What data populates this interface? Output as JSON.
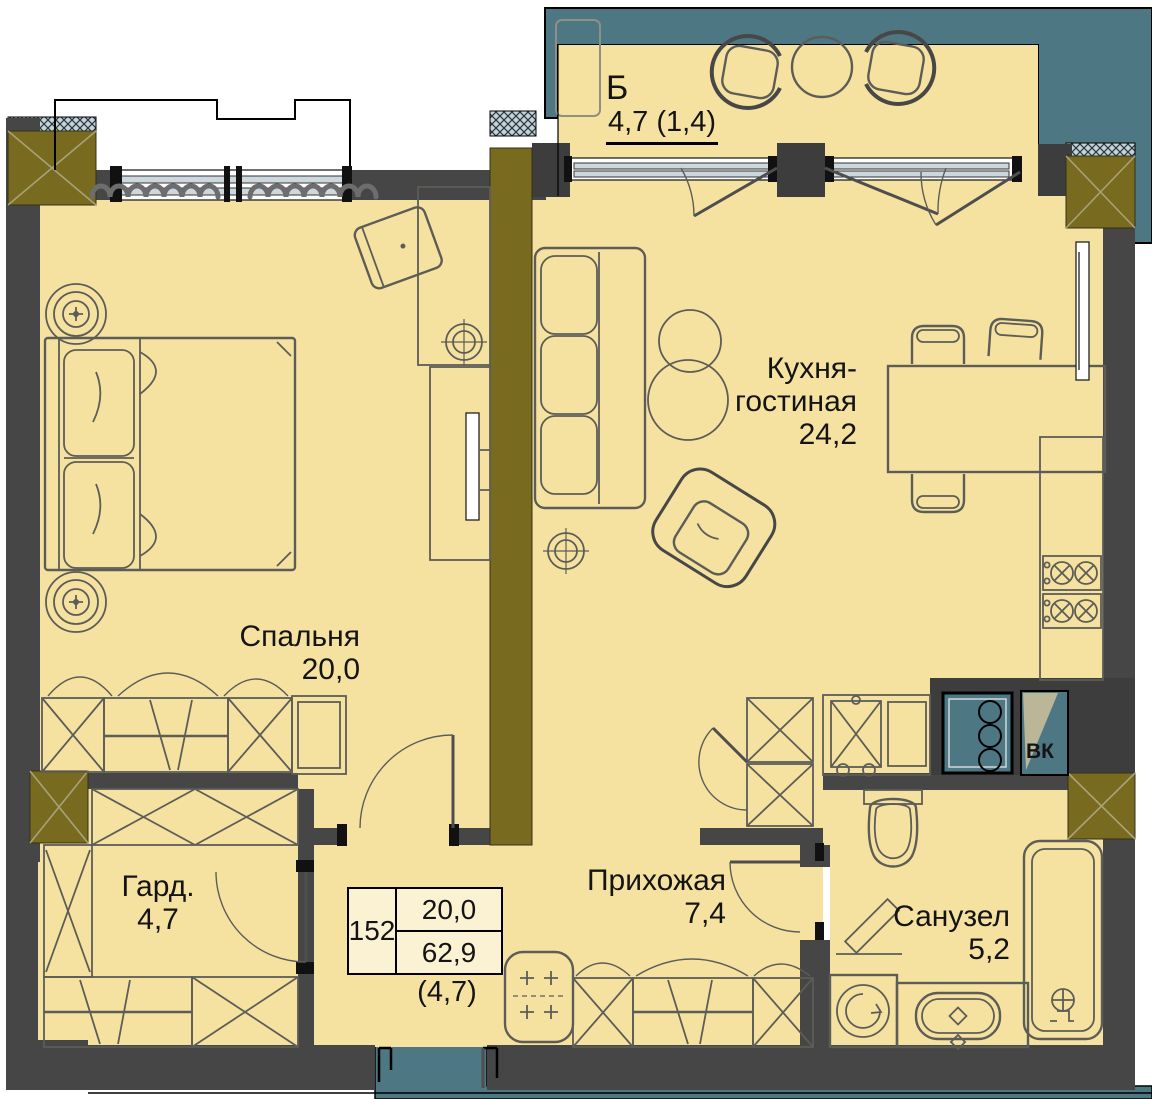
{
  "rooms": {
    "balcony": {
      "short_name": "Б",
      "area": "4,7 (1,4)"
    },
    "kitchen_living": {
      "name_line1": "Кухня-",
      "name_line2": "гостиная",
      "area": "24,2"
    },
    "bedroom": {
      "name": "Спальня",
      "area": "20,0"
    },
    "hallway": {
      "name": "Прихожая",
      "area": "7,4"
    },
    "wardrobe": {
      "name": "Гард.",
      "area": "4,7"
    },
    "bathroom": {
      "name": "Санузел",
      "area": "5,2"
    }
  },
  "shaft": {
    "label": "ВК"
  },
  "stamp": {
    "apartment_number": "152",
    "living_area": "20,0",
    "total_area": "62,9",
    "summer_area": "(4,7)"
  },
  "colors": {
    "floor": "#f6e2a0",
    "wall": "#464646",
    "wall_dark": "#3d3d3d",
    "accent_teal": "#4e7784",
    "pylon_olive": "#786a1e",
    "line": "#5d5d57",
    "text": "#141414"
  }
}
